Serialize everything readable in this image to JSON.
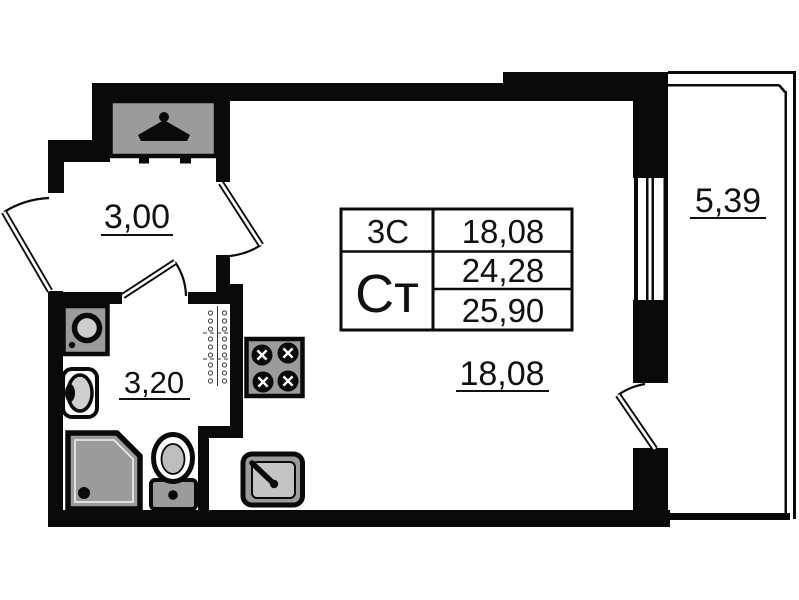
{
  "rooms": {
    "hallway": {
      "area": "3,00"
    },
    "bathroom": {
      "area": "3,20"
    },
    "main_room": {
      "area": "18,08"
    },
    "balcony": {
      "area": "5,39"
    }
  },
  "info_table": {
    "unit_type": "3С",
    "unit_type_area": "18,08",
    "plan_code": "Ст",
    "area_without_balcony": "24,28",
    "area_with_balcony": "25,90"
  },
  "fixtures": [
    "hanger-icon",
    "washing-machine-icon",
    "wash-basin-icon",
    "shower-icon",
    "toilet-icon",
    "vent-shaft",
    "stove-icon",
    "kitchen-sink-icon",
    "window",
    "entrance-door",
    "bathroom-door",
    "main-room-door",
    "balcony-door"
  ],
  "colors": {
    "wall": "#0a0a0a",
    "fixture_fill": "#9b9b9b",
    "background": "#ffffff",
    "text": "#111111"
  }
}
